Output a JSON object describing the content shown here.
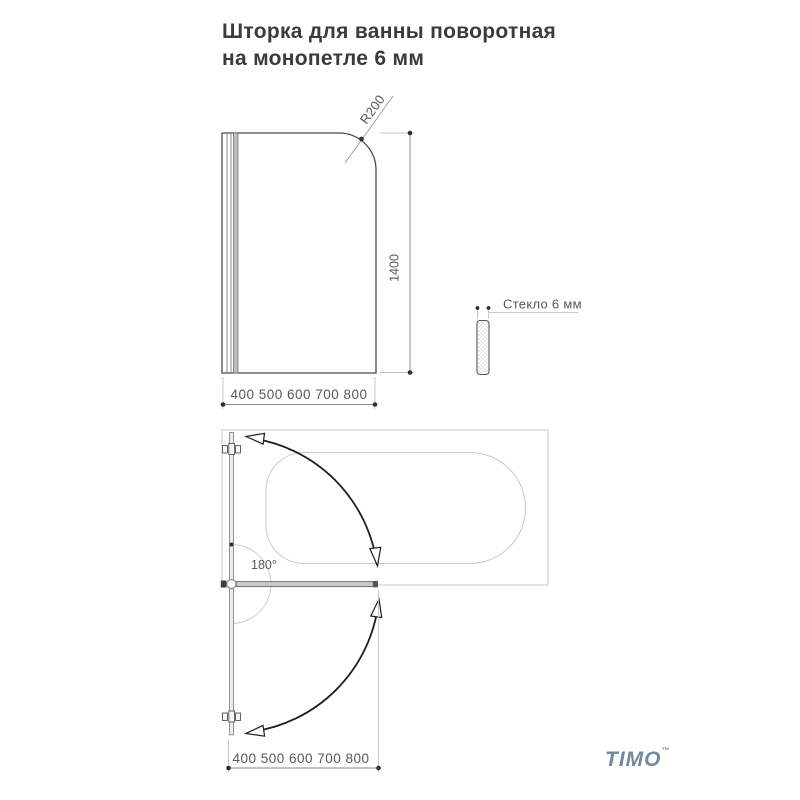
{
  "title": {
    "line1": "Шторка для ванны поворотная",
    "line2": "на монопетле 6 мм"
  },
  "front_view": {
    "corner_radius_label": "R200",
    "height_label": "1400",
    "width_range_label": "400 500 600 700 800"
  },
  "glass_section": {
    "label": "Стекло 6 мм"
  },
  "top_view": {
    "swing_angle_label": "180°",
    "width_range_label": "400 500 600 700 800"
  },
  "logo": {
    "text": "TIMO",
    "trademark": "™",
    "color": "#73879e"
  },
  "colors": {
    "drawing_line": "#3f3f3f",
    "light_outline": "#c9c9c9",
    "dimension_line": "#8a8a8a",
    "swing_arc": "#1f1f1f",
    "text": "#585858"
  }
}
